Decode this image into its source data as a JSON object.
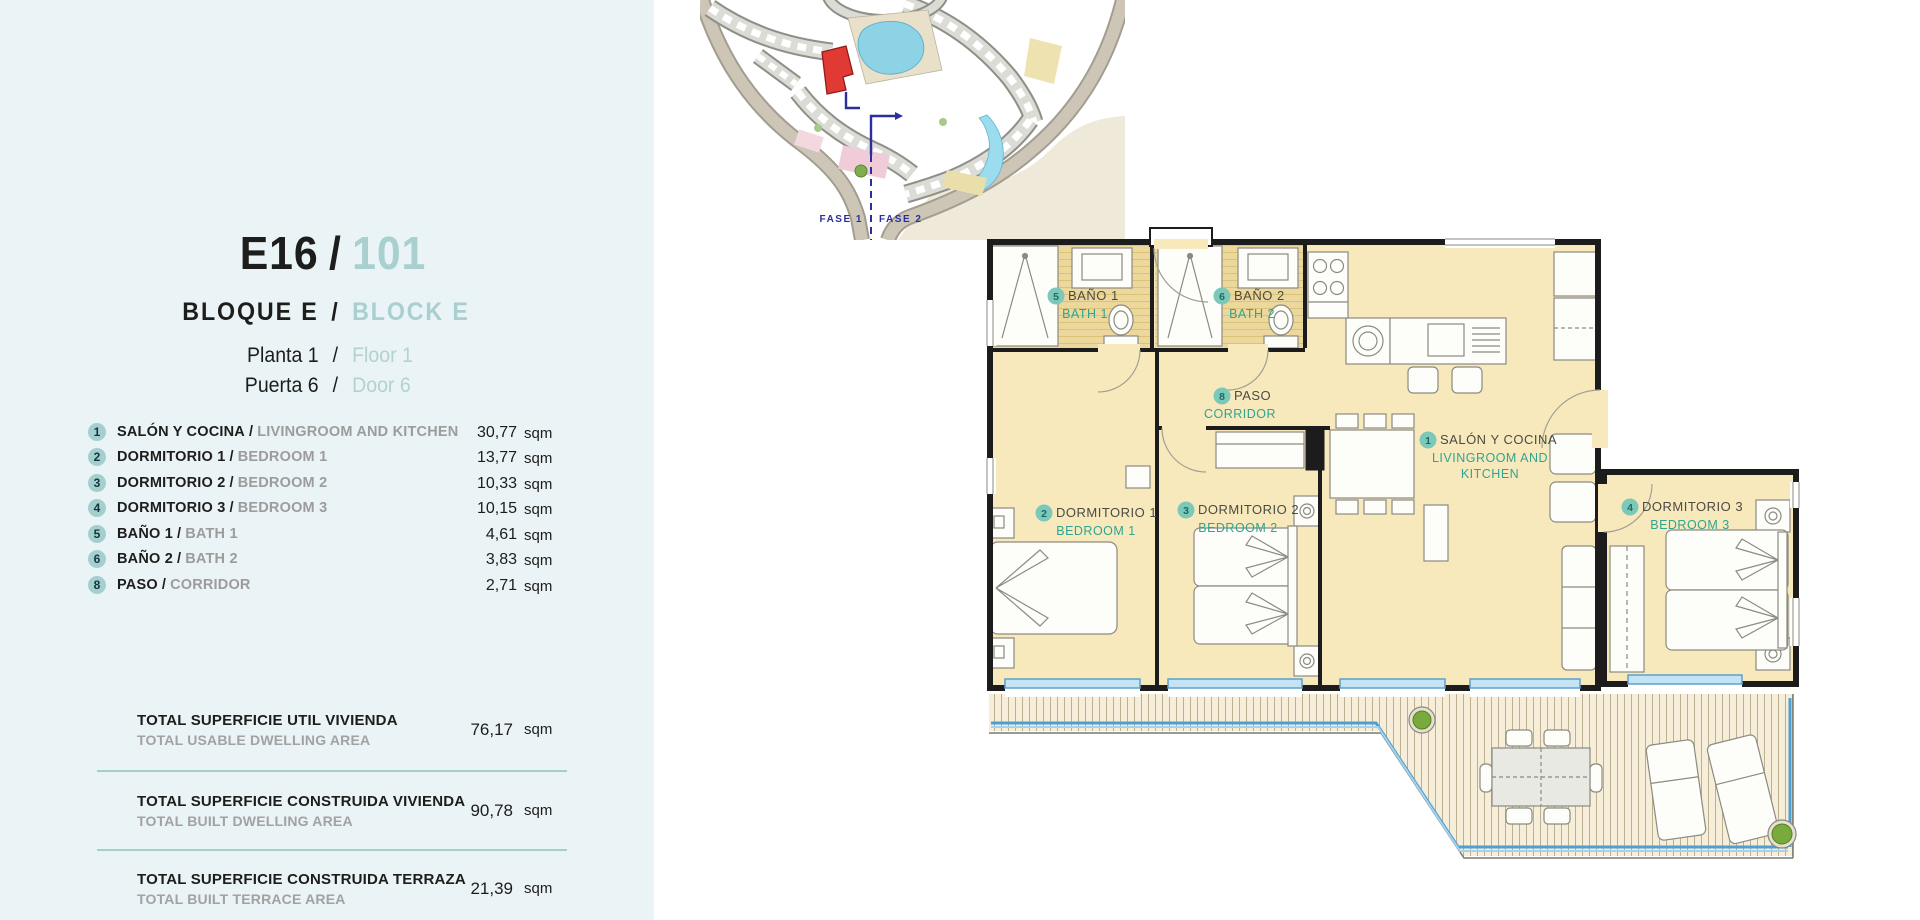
{
  "labels": {
    "sep": "/"
  },
  "header": {
    "code": "E16",
    "number": "101",
    "block_es": "BLOQUE E",
    "block_en": "BLOCK E",
    "floor_es": "Planta 1",
    "floor_en": "Floor 1",
    "door_es": "Puerta 6",
    "door_en": "Door 6"
  },
  "rooms": [
    {
      "num": "1",
      "es": "SALÓN Y COCINA",
      "en": "LIVINGROOM AND KITCHEN",
      "value": "30,77",
      "unit": "sqm"
    },
    {
      "num": "2",
      "es": "DORMITORIO 1",
      "en": "BEDROOM 1",
      "value": "13,77",
      "unit": "sqm"
    },
    {
      "num": "3",
      "es": "DORMITORIO 2",
      "en": "BEDROOM 2",
      "value": "10,33",
      "unit": "sqm"
    },
    {
      "num": "4",
      "es": "DORMITORIO 3",
      "en": "BEDROOM 3",
      "value": "10,15",
      "unit": "sqm"
    },
    {
      "num": "5",
      "es": "BAÑO 1",
      "en": "BATH 1",
      "value": "4,61",
      "unit": "sqm"
    },
    {
      "num": "6",
      "es": "BAÑO 2",
      "en": "BATH 2",
      "value": "3,83",
      "unit": "sqm"
    },
    {
      "num": "8",
      "es": "PASO",
      "en": "CORRIDOR",
      "value": "2,71",
      "unit": "sqm"
    }
  ],
  "totals": [
    {
      "es": "TOTAL SUPERFICIE UTIL VIVIENDA",
      "en": "TOTAL USABLE DWELLING AREA",
      "value": "76,17",
      "unit": "sqm"
    },
    {
      "es": "TOTAL SUPERFICIE CONSTRUIDA VIVIENDA",
      "en": "TOTAL BUILT DWELLING AREA",
      "value": "90,78",
      "unit": "sqm"
    },
    {
      "es": "TOTAL SUPERFICIE CONSTRUIDA TERRAZA",
      "en": "TOTAL BUILT TERRACE AREA",
      "value": "21,39",
      "unit": "sqm"
    }
  ],
  "site_plan": {
    "fase1": "FASE 1",
    "fase2": "FASE 2"
  },
  "floor_plan": {
    "rooms": {
      "living": {
        "num": "1",
        "es": "SALÓN Y COCINA",
        "en1": "LIVINGROOM AND",
        "en2": "KITCHEN"
      },
      "bed1": {
        "num": "2",
        "es": "DORMITORIO 1",
        "en": "BEDROOM 1"
      },
      "bed2": {
        "num": "3",
        "es": "DORMITORIO 2",
        "en": "BEDROOM 2"
      },
      "bed3": {
        "num": "4",
        "es": "DORMITORIO 3",
        "en": "BEDROOM 3"
      },
      "bath1": {
        "num": "5",
        "es": "BAÑO 1",
        "en": "BATH 1"
      },
      "bath2": {
        "num": "6",
        "es": "BAÑO 2",
        "en": "BATH 2"
      },
      "corridor": {
        "num": "8",
        "es": "PASO",
        "en": "CORRIDOR"
      }
    }
  },
  "colors": {
    "sidebar_bg": "#eaf3f6",
    "accent_teal": "#a9cfce",
    "badge_bg": "#a3d0cf",
    "divider": "#a3d1c5",
    "plan_floor": "#f8e9bc",
    "plan_label_en": "#2fa492",
    "wall": "#1c1c1c",
    "terrace_rail": "#4f9fd4",
    "highlight_red": "#e13a35",
    "phase_line": "#2a2f9e"
  }
}
